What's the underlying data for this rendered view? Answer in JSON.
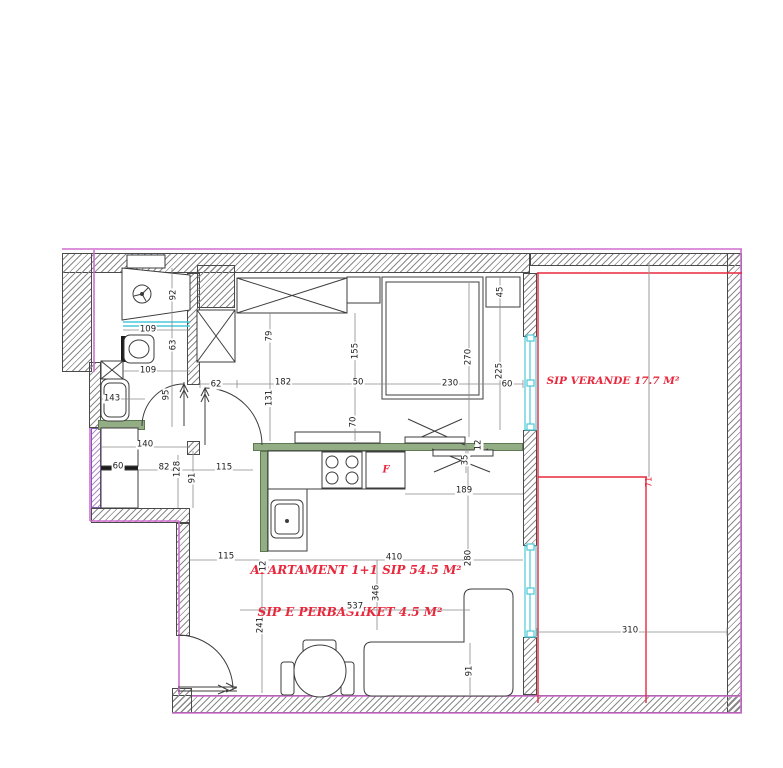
{
  "plan": {
    "room_labels": [
      {
        "text": "SIP  VERANDE  17.7 M²",
        "x": 613,
        "y": 381,
        "fs": 10.5,
        "color": "#e8283c"
      },
      {
        "text": "APARTAMENT 1+1 SIP 54.5 M²",
        "x": 356,
        "y": 570,
        "fs": 12,
        "color": "#e8283c"
      },
      {
        "text": "SIP E PERBASHKET  4.5 M²",
        "x": 350,
        "y": 612,
        "fs": 12,
        "color": "#e8283c"
      }
    ],
    "fridge_label": "F",
    "dimensions": [
      {
        "v": "109",
        "x": 148,
        "y": 330
      },
      {
        "v": "109",
        "x": 148,
        "y": 371
      },
      {
        "v": "143",
        "x": 112,
        "y": 399
      },
      {
        "v": "62",
        "x": 216,
        "y": 385
      },
      {
        "v": "182",
        "x": 283,
        "y": 383
      },
      {
        "v": "50",
        "x": 358,
        "y": 383
      },
      {
        "v": "230",
        "x": 450,
        "y": 384
      },
      {
        "v": "140",
        "x": 145,
        "y": 445
      },
      {
        "v": "60",
        "x": 118,
        "y": 467
      },
      {
        "v": "82",
        "x": 164,
        "y": 468
      },
      {
        "v": "115",
        "x": 224,
        "y": 468
      },
      {
        "v": "115",
        "x": 226,
        "y": 557
      },
      {
        "v": "410",
        "x": 394,
        "y": 558
      },
      {
        "v": "189",
        "x": 464,
        "y": 491
      },
      {
        "v": "537",
        "x": 355,
        "y": 607
      },
      {
        "v": "310",
        "x": 630,
        "y": 631
      },
      {
        "v": "60",
        "x": 507,
        "y": 385
      },
      {
        "v": "92",
        "x": 174,
        "y": 295,
        "rot": true
      },
      {
        "v": "63",
        "x": 174,
        "y": 345,
        "rot": true
      },
      {
        "v": "95",
        "x": 167,
        "y": 395,
        "rot": true
      },
      {
        "v": "79",
        "x": 270,
        "y": 336,
        "rot": true
      },
      {
        "v": "131",
        "x": 270,
        "y": 398,
        "rot": true
      },
      {
        "v": "155",
        "x": 356,
        "y": 351,
        "rot": true
      },
      {
        "v": "70",
        "x": 354,
        "y": 422,
        "rot": true
      },
      {
        "v": "270",
        "x": 469,
        "y": 357,
        "rot": true
      },
      {
        "v": "45",
        "x": 501,
        "y": 292,
        "rot": true
      },
      {
        "v": "225",
        "x": 500,
        "y": 371,
        "rot": true
      },
      {
        "v": "128",
        "x": 178,
        "y": 469,
        "rot": true
      },
      {
        "v": "91",
        "x": 193,
        "y": 478,
        "rot": true
      },
      {
        "v": "12",
        "x": 264,
        "y": 566,
        "rot": true
      },
      {
        "v": "12",
        "x": 479,
        "y": 445,
        "rot": true
      },
      {
        "v": "35",
        "x": 466,
        "y": 460,
        "rot": true
      },
      {
        "v": "280",
        "x": 469,
        "y": 558,
        "rot": true
      },
      {
        "v": "346",
        "x": 377,
        "y": 593,
        "rot": true
      },
      {
        "v": "241",
        "x": 261,
        "y": 625,
        "rot": true
      },
      {
        "v": "91",
        "x": 470,
        "y": 671,
        "rot": true
      },
      {
        "v": "71",
        "x": 650,
        "y": 482,
        "rot": true,
        "red": true
      }
    ],
    "colors": {
      "accent_red": "#e8283c",
      "boundary_magenta": "#cf6fcf",
      "window_cyan": "#4cc8d8",
      "counter_green": "#93ad85",
      "wall_line": "#4a4a4a"
    }
  }
}
